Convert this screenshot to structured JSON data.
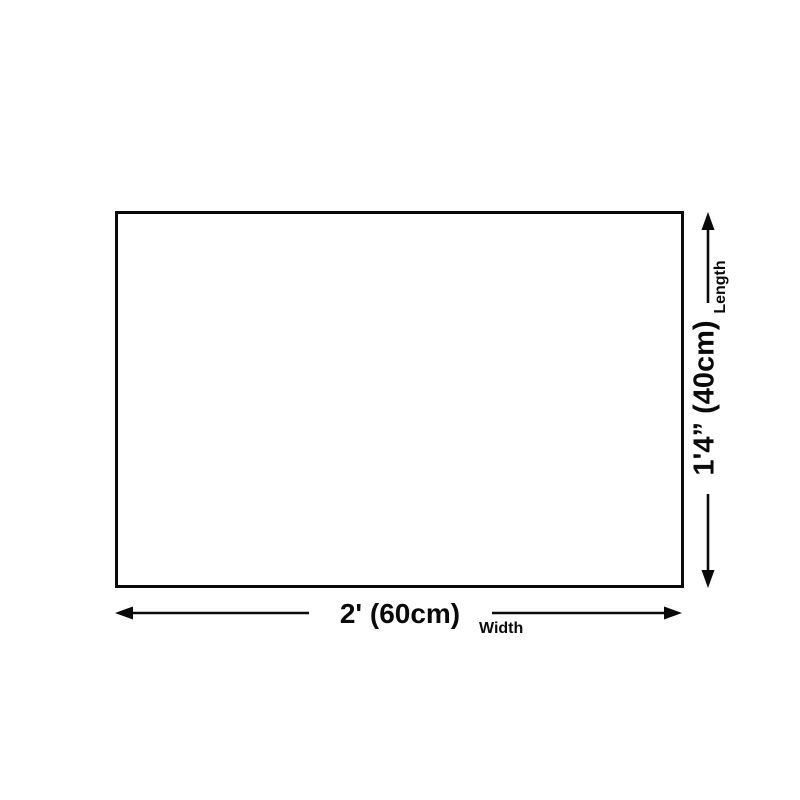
{
  "diagram": {
    "title": "product-size-diagram",
    "length": {
      "value": "1'4” (40cm)",
      "label": "Length"
    },
    "width": {
      "value": "2' (60cm)",
      "label": "Width"
    },
    "colors": {
      "line": "#0a0a0a",
      "background": "#ffffff",
      "outline_fill": "#ffffff"
    }
  }
}
